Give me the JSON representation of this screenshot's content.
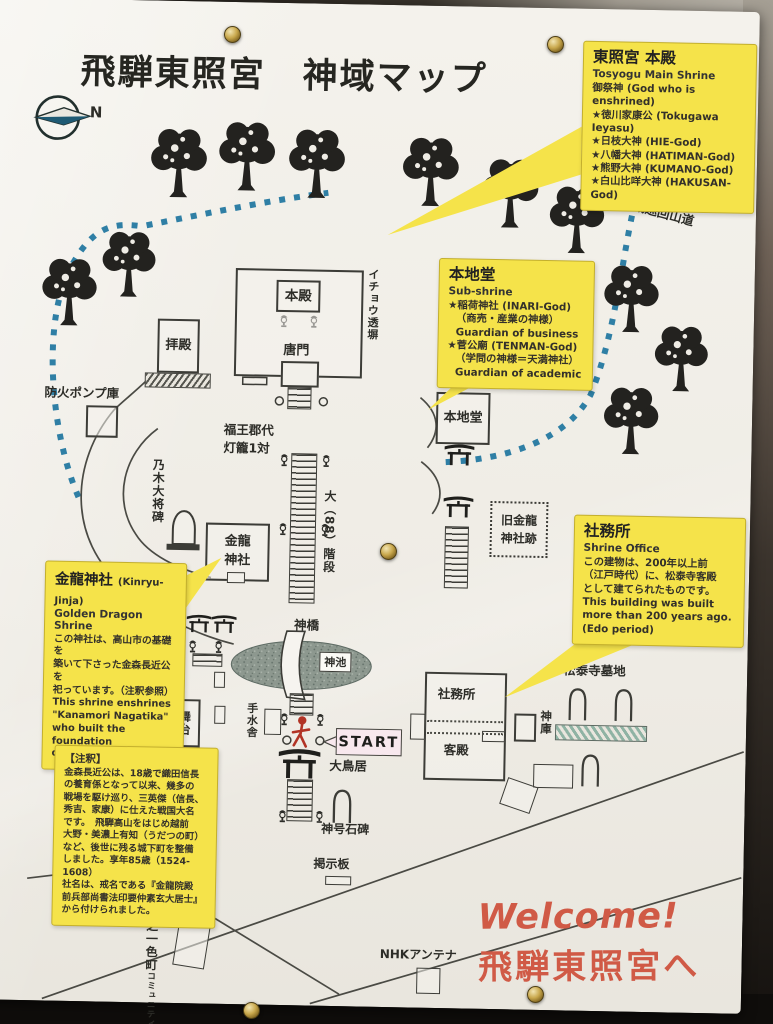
{
  "poster": {
    "title": "飛騨東照宮　神域マップ",
    "compass": {
      "label": "N"
    },
    "trail_label": "神域巡回山道",
    "welcome": {
      "line1": "Welcome!",
      "line2": "飛騨東照宮へ"
    },
    "callouts": {
      "main_shrine": {
        "title": "東照宮 本殿",
        "subtitle": "Tosyogu Main Shrine",
        "lines": [
          "御祭神 (God who is enshrined)",
          "★徳川家康公 (Tokugawa Ieyasu)",
          "★日枝大神 (HIE-God)",
          "★八幡大神 (HATIMAN-God)",
          "★熊野大神 (KUMANO-God)",
          "★白山比咩大神 (HAKUSAN-God)"
        ]
      },
      "sub_shrine": {
        "title": "本地堂",
        "subtitle": "Sub-shrine",
        "lines": [
          "★稲荷神社 (INARI-God)",
          "（商売・産業の神様）",
          "Guardian of business",
          "★菅公廟 (TENMAN-God)",
          "（学問の神様＝天満神社）",
          "Guardian of academic"
        ]
      },
      "shrine_office": {
        "title": "社務所",
        "subtitle": "Shrine Office",
        "lines": [
          "この建物は、200年以上前",
          "（江戸時代）に、松泰寺客殿",
          "として建てられたものです。",
          "This building was built",
          "more than 200 years ago.",
          "(Edo period)"
        ]
      },
      "kinryu_shrine": {
        "title": "金龍神社",
        "title_en": "(Kinryu-Jinja)",
        "subtitle": "Golden Dragon Shrine",
        "lines": [
          "この神社は、高山市の基礎を",
          "築いて下さった金森長近公を",
          "祀っています。（注釈参照）",
          "This shrine enshrines",
          "\"Kanamori Nagatika\"",
          "who built the foundation",
          "of Takayama-city."
        ]
      },
      "note": {
        "title": "【注釈】",
        "lines": [
          "金森長近公は、18歳で織田信長",
          "の養育係となって以来、幾多の",
          "戦場を駆け巡り、三英傑（信長、",
          "秀吉、家康）に仕えた戦国大名",
          "です。　飛騨高山をはじめ越前",
          "大野・美濃上有知（うだつの町）",
          "など、後世に残る城下町を整備",
          "しました。享年85歳（1524-1608）",
          "社名は、戒名である『金龍院殿",
          "前兵部尚書法印要仲素玄大居士』",
          "から付けられました。"
        ]
      }
    },
    "map_labels": {
      "honden": "本殿",
      "haiden": "拝殿",
      "karamon": "唐門",
      "icho_fence": "イチョウ透塀",
      "fire_pump": "防火ポンプ庫",
      "fukuo1": "福王郡代",
      "fukuo2": "灯籠1対",
      "nogi": "乃木大将碑",
      "kinryu1": "金龍",
      "kinryu2": "神社",
      "big_stairs": "大（88）階段",
      "honjido": "本地堂",
      "old_kinryu1": "旧金龍",
      "old_kinryu2": "神社跡",
      "shinkyo": "神橋",
      "shinchi": "神池",
      "temizuya": "手水舎",
      "butai": "舞台",
      "start": "START",
      "odorii": "大鳥居",
      "shamusho": "社務所",
      "kyakuden": "客殿",
      "shinko": "神庫",
      "bochi": "松泰寺墓地",
      "sekihi": "神号石碑",
      "keijiban": "掲示板",
      "nhk": "NHKアンテナ",
      "nishi1": "西之一色町",
      "nishi2": "コミュニティセンター"
    },
    "icons": {
      "compass": "compass-rose-arrow",
      "tree": "deciduous-tree",
      "torii": "torii-gate",
      "lantern": "stone-lantern",
      "grave": "gravestone-arch",
      "person": "red-walking-person",
      "pin": "brass-push-pin"
    },
    "colors": {
      "callout_yellow": "#f5e34a",
      "trail_blue": "#2f7fa5",
      "welcome_red": "#d05a46",
      "pond_gray_green": "#8d988f",
      "line_dark": "#3c3c37"
    }
  }
}
